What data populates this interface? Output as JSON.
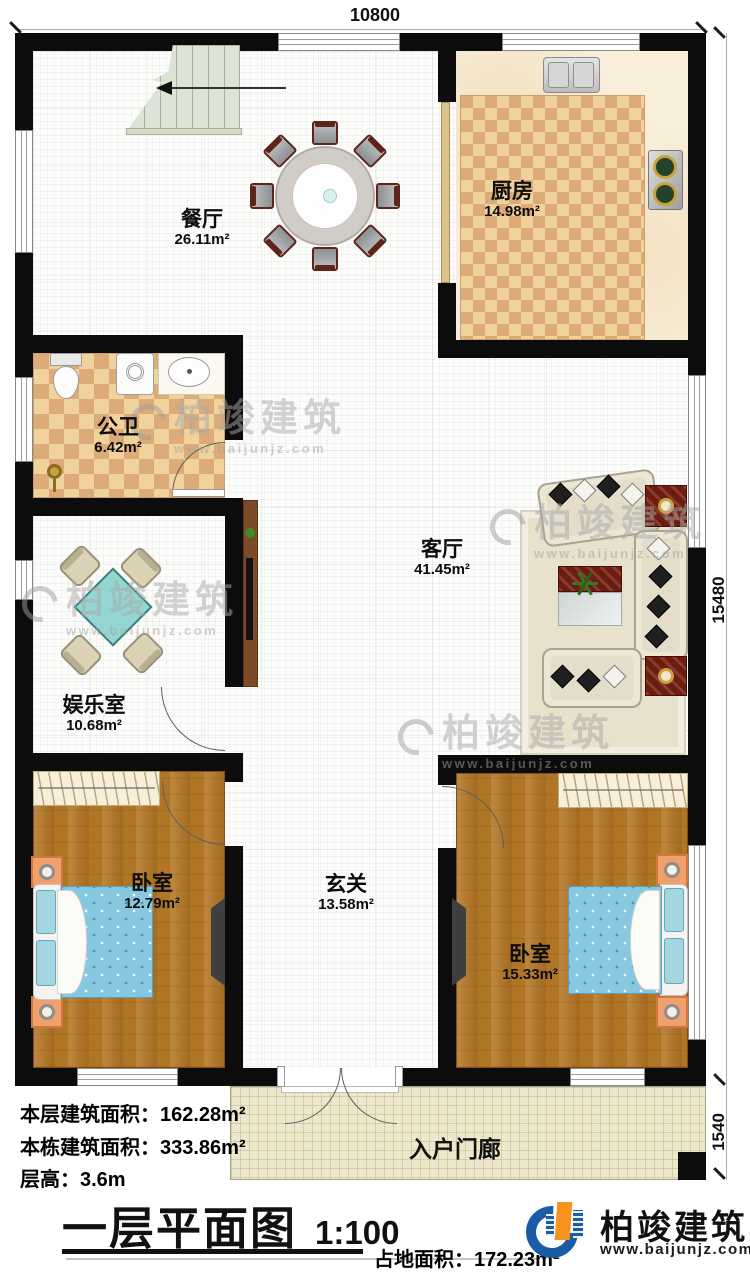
{
  "dimensions": {
    "top": "10800",
    "right": "15480",
    "porch_right": "1540"
  },
  "rooms": {
    "dining": {
      "name": "餐厅",
      "area": "26.11m²"
    },
    "kitchen": {
      "name": "厨房",
      "area": "14.98m²"
    },
    "bathroom": {
      "name": "公卫",
      "area": "6.42m²"
    },
    "living": {
      "name": "客厅",
      "area": "41.45m²"
    },
    "entertainment": {
      "name": "娱乐室",
      "area": "10.68m²"
    },
    "bedroom_left": {
      "name": "卧室",
      "area": "12.79m²"
    },
    "foyer": {
      "name": "玄关",
      "area": "13.58m²"
    },
    "bedroom_right": {
      "name": "卧室",
      "area": "15.33m²"
    },
    "porch": {
      "name": "入户门廊"
    }
  },
  "stats": {
    "floor_area": {
      "label": "本层建筑面积：",
      "value": "162.28m²"
    },
    "building_area": {
      "label": "本栋建筑面积：",
      "value": "333.86m²"
    },
    "floor_height": {
      "label": "层高：",
      "value": "3.6m"
    },
    "footprint": {
      "label": "占地面积：",
      "value": "172.23m²"
    }
  },
  "title": {
    "text": "一层平面图",
    "scale": "1:100"
  },
  "brand": {
    "name": "柏竣建筑",
    "url": "www.baijunjz.com"
  }
}
